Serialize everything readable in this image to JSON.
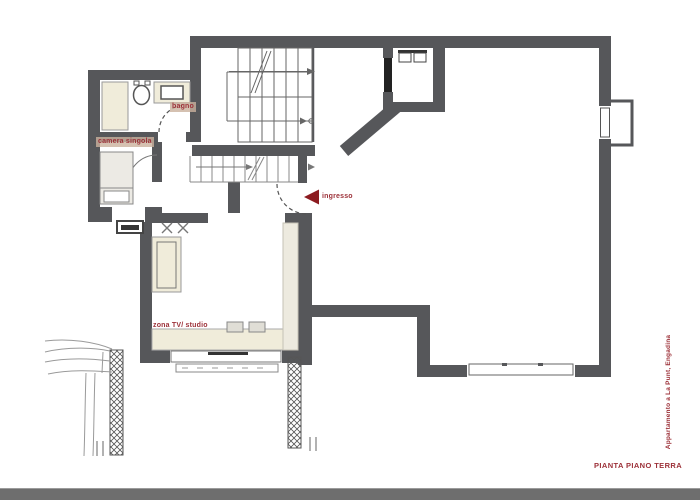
{
  "document": {
    "title": "PIANTA PIANO TERRA",
    "project": "Appartamento a La Punt, Engadina"
  },
  "rooms": {
    "bagno": "bagno",
    "camera_singola": "camera singola",
    "ingresso": "ingresso",
    "zona_tv_studio": "zona TV/ studio"
  },
  "colors": {
    "wall": "#56575a",
    "label_red": "#9c3038",
    "arrow_red": "#8c1b20",
    "furniture_beige": "#f0ecda",
    "footer_bar": "#6e6e6e"
  }
}
